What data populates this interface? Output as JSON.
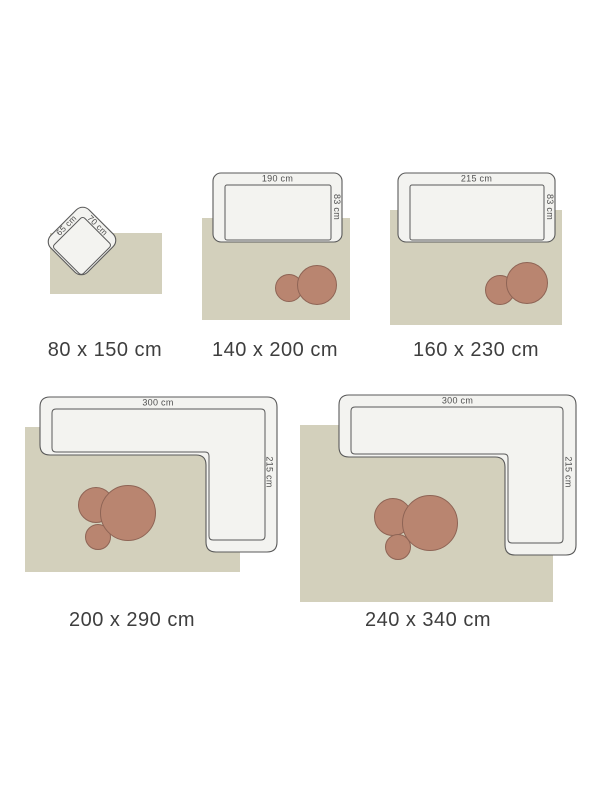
{
  "colors": {
    "page_bg": "#ffffff",
    "rug": "#d3d0bc",
    "circle_fill": "#b98570",
    "circle_stroke": "#8e6455",
    "furniture_fill": "#f3f3f0",
    "furniture_stroke": "#5a5a5a",
    "dim_label_color": "#4f4f4f",
    "size_label_color": "#3e3e3e"
  },
  "items": [
    {
      "id": "80x150",
      "size_label": "80 x 150 cm",
      "furniture": {
        "type": "armchair",
        "width_label": "65 cm",
        "depth_label": "70 cm"
      },
      "pattern_circles": 0
    },
    {
      "id": "140x200",
      "size_label": "140 x 200 cm",
      "furniture": {
        "type": "sofa",
        "width_label": "190 cm",
        "depth_label": "83 cm"
      },
      "pattern_circles": 2
    },
    {
      "id": "160x230",
      "size_label": "160 x 230 cm",
      "furniture": {
        "type": "sofa",
        "width_label": "215 cm",
        "depth_label": "83 cm"
      },
      "pattern_circles": 2
    },
    {
      "id": "200x290",
      "size_label": "200 x 290 cm",
      "furniture": {
        "type": "corner-sofa",
        "width_label": "300 cm",
        "depth_label": "215 cm"
      },
      "pattern_circles": 3
    },
    {
      "id": "240x340",
      "size_label": "240 x 340 cm",
      "furniture": {
        "type": "corner-sofa",
        "width_label": "300 cm",
        "depth_label": "215 cm"
      },
      "pattern_circles": 3
    }
  ]
}
